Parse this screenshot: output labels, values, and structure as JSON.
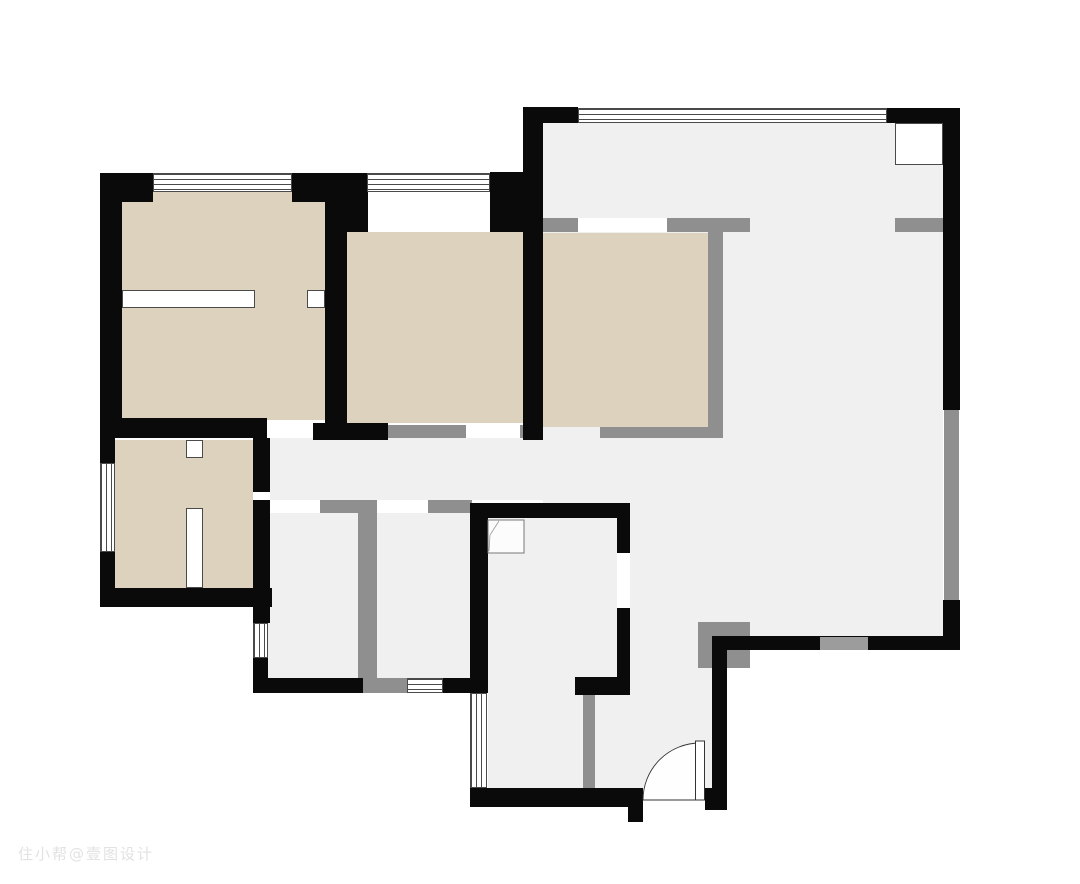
{
  "watermark": {
    "text": "住小帮@壹图设计"
  },
  "palette": {
    "bg": "#ffffff",
    "wall_black": "#0a0a0a",
    "wall_gray": "#8f8f8f",
    "opening_gray": "#9c9c9c",
    "floor": "#f0f0f1",
    "room_tan": "#dcd2be",
    "window_line": "#4a4a4a",
    "stroke": "#333333"
  },
  "canvas": {
    "width": 1080,
    "height": 884
  },
  "plan": {
    "floors": [
      {
        "n": "living-dining-floor",
        "x": 543,
        "y": 123,
        "w": 400,
        "h": 513
      },
      {
        "n": "corridor-floor",
        "x": 255,
        "y": 438,
        "w": 457,
        "h": 62
      },
      {
        "n": "room-a-floor",
        "x": 268,
        "y": 513,
        "w": 94,
        "h": 165
      },
      {
        "n": "room-b-floor",
        "x": 377,
        "y": 513,
        "w": 95,
        "h": 165
      },
      {
        "n": "bath-floor",
        "x": 488,
        "y": 518,
        "w": 129,
        "h": 159
      },
      {
        "n": "bath-ext-floor",
        "x": 488,
        "y": 677,
        "w": 95,
        "h": 111
      },
      {
        "n": "entry-floor",
        "x": 630,
        "y": 636,
        "w": 82,
        "h": 152
      },
      {
        "n": "entry-floor-west",
        "x": 595,
        "y": 695,
        "w": 35,
        "h": 93
      }
    ],
    "tan_rooms": [
      {
        "n": "bedroom1-floor",
        "x": 122,
        "y": 192,
        "w": 203,
        "h": 228
      },
      {
        "n": "bedroom2-floor",
        "x": 347,
        "y": 232,
        "w": 180,
        "h": 191
      },
      {
        "n": "bedroom3-floor",
        "x": 543,
        "y": 233,
        "w": 165,
        "h": 194
      },
      {
        "n": "closet-room-floor",
        "x": 115,
        "y": 440,
        "w": 140,
        "h": 148
      }
    ],
    "white_overlays": [
      {
        "n": "bed2-bay-recess",
        "x": 368,
        "y": 188,
        "w": 122,
        "h": 44,
        "b": 0
      },
      {
        "n": "shaft-box",
        "x": 895,
        "y": 123,
        "w": 48,
        "h": 42,
        "b": 1
      },
      {
        "n": "bed1-partition-a",
        "x": 122,
        "y": 290,
        "w": 133,
        "h": 18,
        "b": 1
      },
      {
        "n": "bed1-partition-b",
        "x": 307,
        "y": 290,
        "w": 18,
        "h": 18,
        "b": 1
      },
      {
        "n": "closet-partition-top",
        "x": 186,
        "y": 440,
        "w": 17,
        "h": 18,
        "b": 1
      },
      {
        "n": "closet-partition",
        "x": 186,
        "y": 508,
        "w": 17,
        "h": 80,
        "b": 1
      }
    ],
    "gray_walls": [
      {
        "n": "bed3-wall-top",
        "x": 540,
        "y": 218,
        "w": 210,
        "h": 14
      },
      {
        "n": "bed3-wall-right",
        "x": 708,
        "y": 218,
        "w": 15,
        "h": 220
      },
      {
        "n": "bed3-wall-bottom",
        "x": 600,
        "y": 427,
        "w": 123,
        "h": 11
      },
      {
        "n": "bed2-wall-bottom",
        "x": 388,
        "y": 425,
        "w": 78,
        "h": 13
      },
      {
        "n": "bed2-wall-bottom-b",
        "x": 520,
        "y": 425,
        "w": 7,
        "h": 13
      },
      {
        "n": "kitchen-wall-stub",
        "x": 895,
        "y": 218,
        "w": 48,
        "h": 14
      },
      {
        "n": "balcony-rail-right",
        "x": 944,
        "y": 410,
        "w": 15,
        "h": 190
      },
      {
        "n": "corridor-wall-a",
        "x": 320,
        "y": 500,
        "w": 38,
        "h": 13
      },
      {
        "n": "corridor-wall-b",
        "x": 428,
        "y": 500,
        "w": 44,
        "h": 13
      },
      {
        "n": "rooms-divider",
        "x": 358,
        "y": 500,
        "w": 19,
        "h": 178
      },
      {
        "n": "rooms-divider-foot",
        "x": 362,
        "y": 678,
        "w": 45,
        "h": 15
      },
      {
        "n": "bath-gray-wall",
        "x": 583,
        "y": 695,
        "w": 12,
        "h": 93
      },
      {
        "n": "closet-gray-block",
        "x": 253,
        "y": 498,
        "w": 17,
        "h": 14
      },
      {
        "n": "entry-gray-corner",
        "x": 698,
        "y": 622,
        "w": 52,
        "h": 46
      }
    ],
    "black_walls": [
      {
        "n": "wall-corner-tl",
        "x": 100,
        "y": 173,
        "w": 53,
        "h": 29
      },
      {
        "n": "wall-left",
        "x": 100,
        "y": 173,
        "w": 22,
        "h": 265
      },
      {
        "n": "wall-top-mid",
        "x": 292,
        "y": 173,
        "w": 76,
        "h": 19
      },
      {
        "n": "wall-top-mid-b",
        "x": 292,
        "y": 192,
        "w": 33,
        "h": 10
      },
      {
        "n": "wall-bed2-left-corner",
        "x": 347,
        "y": 188,
        "w": 21,
        "h": 44
      },
      {
        "n": "wall-divider-bed12",
        "x": 325,
        "y": 192,
        "w": 22,
        "h": 248
      },
      {
        "n": "wall-bed2-right-corner",
        "x": 490,
        "y": 172,
        "w": 37,
        "h": 60
      },
      {
        "n": "wall-living-left",
        "x": 523,
        "y": 107,
        "w": 20,
        "h": 333
      },
      {
        "n": "wall-living-top-left",
        "x": 527,
        "y": 107,
        "w": 51,
        "h": 16
      },
      {
        "n": "wall-living-top-right",
        "x": 887,
        "y": 108,
        "w": 73,
        "h": 15
      },
      {
        "n": "wall-right-upper",
        "x": 943,
        "y": 108,
        "w": 17,
        "h": 302
      },
      {
        "n": "wall-right-lower",
        "x": 943,
        "y": 600,
        "w": 17,
        "h": 50
      },
      {
        "n": "wall-living-bottom",
        "x": 712,
        "y": 636,
        "w": 248,
        "h": 14
      },
      {
        "n": "wall-entry-right",
        "x": 712,
        "y": 636,
        "w": 15,
        "h": 171
      },
      {
        "n": "wall-bed1-bottom",
        "x": 100,
        "y": 418,
        "w": 167,
        "h": 20
      },
      {
        "n": "wall-bed2-bottom-left",
        "x": 313,
        "y": 423,
        "w": 75,
        "h": 17
      },
      {
        "n": "wall-closet-left-a",
        "x": 100,
        "y": 438,
        "w": 15,
        "h": 25
      },
      {
        "n": "wall-closet-left-b",
        "x": 100,
        "y": 552,
        "w": 15,
        "h": 55
      },
      {
        "n": "wall-closet-bottom",
        "x": 100,
        "y": 588,
        "w": 172,
        "h": 19
      },
      {
        "n": "wall-closet-right",
        "x": 253,
        "y": 425,
        "w": 17,
        "h": 67
      },
      {
        "n": "wall-rooma-left",
        "x": 253,
        "y": 500,
        "w": 17,
        "h": 123
      },
      {
        "n": "wall-rooma-left-b",
        "x": 253,
        "y": 658,
        "w": 15,
        "h": 35
      },
      {
        "n": "wall-rooma-bottom",
        "x": 253,
        "y": 678,
        "w": 110,
        "h": 15
      },
      {
        "n": "wall-roomb-bottom",
        "x": 443,
        "y": 678,
        "w": 45,
        "h": 15
      },
      {
        "n": "wall-bath-top",
        "x": 470,
        "y": 503,
        "w": 160,
        "h": 15
      },
      {
        "n": "wall-bath-left",
        "x": 470,
        "y": 503,
        "w": 18,
        "h": 190
      },
      {
        "n": "wall-bath-right-a",
        "x": 617,
        "y": 503,
        "w": 13,
        "h": 50
      },
      {
        "n": "wall-bath-right-b",
        "x": 617,
        "y": 608,
        "w": 13,
        "h": 69
      },
      {
        "n": "wall-bath-bottom",
        "x": 575,
        "y": 677,
        "w": 55,
        "h": 18
      },
      {
        "n": "wall-entry-bottom",
        "x": 470,
        "y": 788,
        "w": 173,
        "h": 19
      },
      {
        "n": "wall-door-stub",
        "x": 628,
        "y": 788,
        "w": 15,
        "h": 34
      },
      {
        "n": "wall-entry-corner",
        "x": 705,
        "y": 788,
        "w": 22,
        "h": 22
      }
    ],
    "door_gaps": [
      {
        "n": "bed1-door-gap",
        "x": 267,
        "y": 420,
        "w": 46,
        "h": 18
      },
      {
        "n": "bed2-door-gap",
        "x": 466,
        "y": 425,
        "w": 54,
        "h": 13
      },
      {
        "n": "bed3-door-gap",
        "x": 578,
        "y": 218,
        "w": 89,
        "h": 14
      },
      {
        "n": "room-a-door-gap",
        "x": 273,
        "y": 500,
        "w": 47,
        "h": 13
      },
      {
        "n": "room-b-door-gap",
        "x": 380,
        "y": 500,
        "w": 48,
        "h": 13
      },
      {
        "n": "bath-door-gap",
        "x": 617,
        "y": 553,
        "w": 13,
        "h": 55
      },
      {
        "n": "closet-door-gap",
        "x": 253,
        "y": 492,
        "w": 17,
        "h": 8
      }
    ],
    "wall_openings": [
      {
        "n": "living-south-opening",
        "x": 820,
        "y": 637,
        "w": 48,
        "h": 13
      }
    ],
    "windows": [
      {
        "n": "bed1-window",
        "x": 153,
        "y": 173,
        "w": 139,
        "h": 19,
        "o": "h"
      },
      {
        "n": "bed2-window",
        "x": 367,
        "y": 173,
        "w": 123,
        "h": 19,
        "o": "h"
      },
      {
        "n": "living-window",
        "x": 578,
        "y": 108,
        "w": 309,
        "h": 15,
        "o": "h"
      },
      {
        "n": "closet-window",
        "x": 100,
        "y": 463,
        "w": 15,
        "h": 89,
        "o": "v"
      },
      {
        "n": "room-a-window",
        "x": 253,
        "y": 623,
        "w": 15,
        "h": 35,
        "o": "v"
      },
      {
        "n": "entry-window",
        "x": 470,
        "y": 693,
        "w": 17,
        "h": 95,
        "o": "v"
      },
      {
        "n": "room-b-window",
        "x": 407,
        "y": 678,
        "w": 36,
        "h": 15,
        "o": "h"
      }
    ],
    "entry_door": {
      "x": 640,
      "y": 738,
      "w": 66,
      "h": 66,
      "arc_path": "M 3 62 A 57 57 0 0 1 60 5",
      "leaf": {
        "x": 55.5,
        "y": 3,
        "w": 9,
        "h": 59
      }
    },
    "shower": {
      "x": 487,
      "y": 519,
      "w": 38,
      "h": 35,
      "fold_path": "M 12 2 L 3 16 L 2 32"
    }
  }
}
